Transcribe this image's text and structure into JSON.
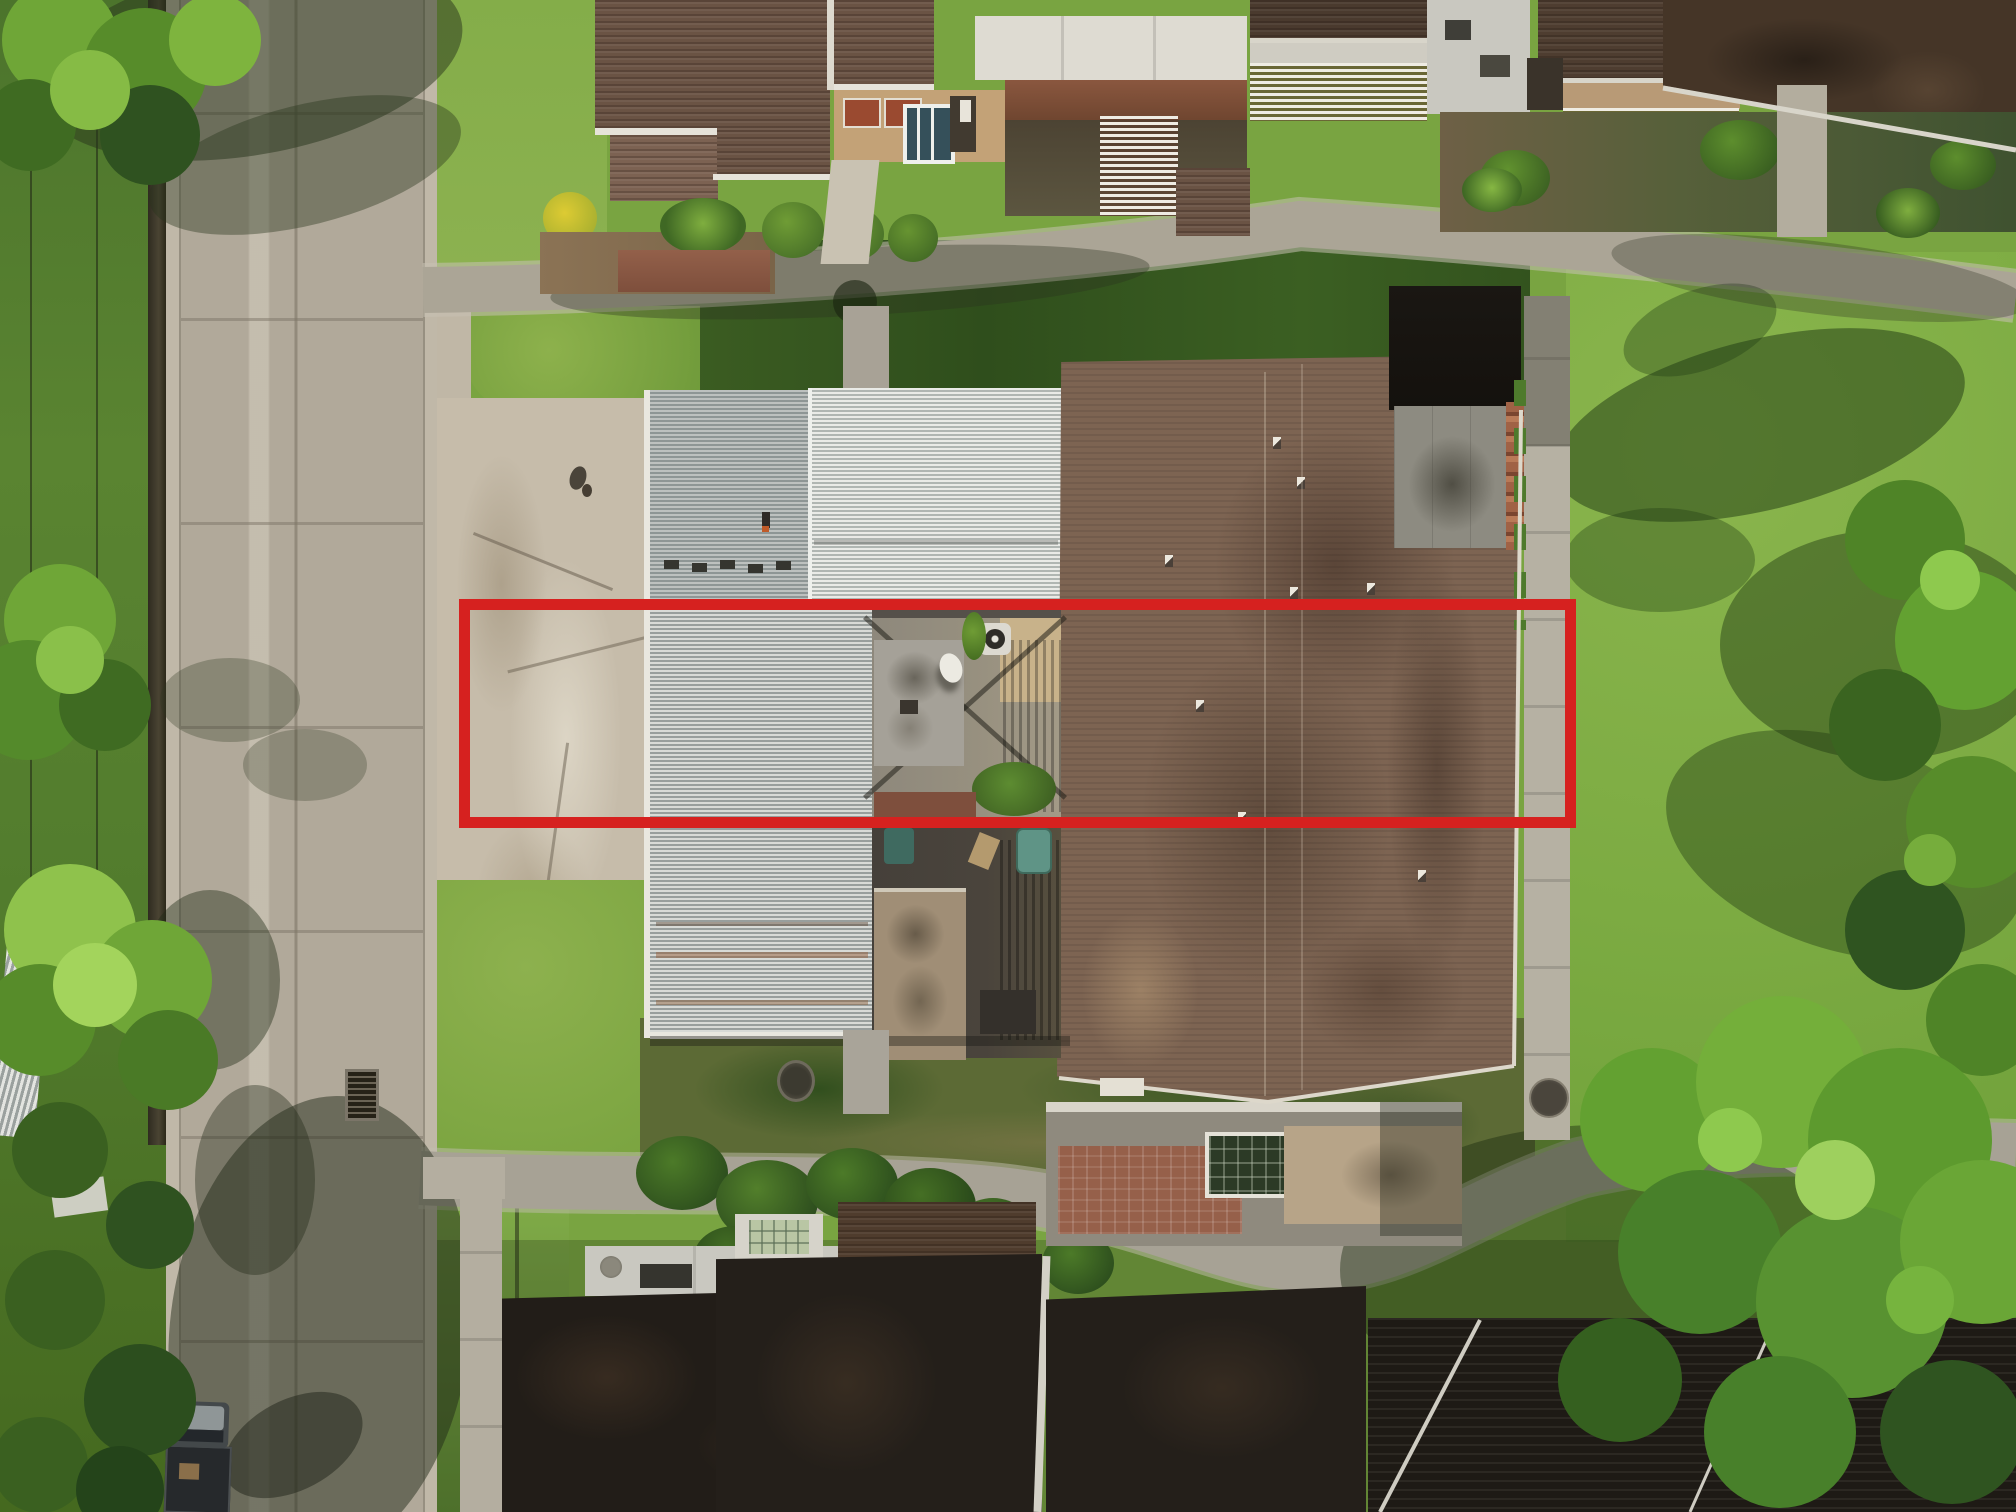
{
  "scene": {
    "type": "aerial-drone-photograph",
    "subject": "townhome community with concrete street on left, central condo building with white corrugated metal roofs and large brown shingle roof, winding sidewalks, lawns and trees",
    "annotation": {
      "name": "property-boundary-outline",
      "shape": "rectangle",
      "color": "#d6211f",
      "border_px": 11,
      "box_style": "left:459px;top:599px;width:1117px;height:229px;border:11px solid #d6211f;"
    },
    "palette": {
      "red_annotation": "#d6211f",
      "street_concrete": "#b1a99a",
      "curb_gutter": "#c0b8a8",
      "parking_pad": "#c6bcaa",
      "sidewalk": "#aba596",
      "corrugated_roof_dark": "#989e9c",
      "corrugated_roof_light": "#eaebe7",
      "brown_shingle_roof": "#7d6452",
      "brown_roof_shadow": "#5a4336",
      "chimney_black": "#16130f",
      "chimney_cap_gray": "#8d8b81",
      "black_townhouse_roof": "#221d18",
      "lawn_bright": "#7cab42",
      "lawn_shaded": "#33511e",
      "tree_canopy_bright": "#74af3a",
      "tree_canopy_dark": "#2f5420",
      "courtyard_tan_wall": "#c8b28a",
      "shed_gray": "#a5a198",
      "shed_tan": "#a08e76",
      "brick_patio": "#96604a",
      "skylight_green": "#b9c6a4",
      "teal_car": "#5f9486",
      "truck_body": "#43484a"
    }
  }
}
